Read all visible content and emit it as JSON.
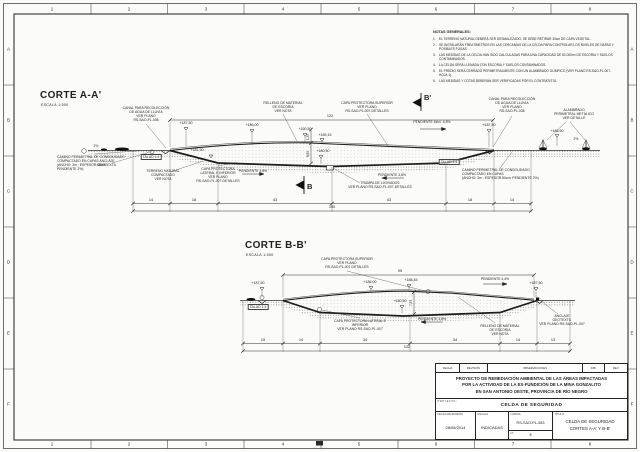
{
  "frame": {
    "cols": [
      "1",
      "2",
      "3",
      "4",
      "5",
      "6",
      "7",
      "8"
    ],
    "rows": [
      "A",
      "B",
      "C",
      "D",
      "E",
      "F"
    ]
  },
  "notes": {
    "title": "NOTAS GENERALES:",
    "items": [
      {
        "num": "1.",
        "text": "EL TERRENO NATURAL DEBERÁ SER DESMALEZADO. SE DEBE RETIRAR 30cm DE CAPA VEGETAL."
      },
      {
        "num": "2.",
        "text": "SE INSTALARÁN FREATÍMETROS EN LAS CERCANÍAS DE LA CELDA PARA CONTROLAR LOS NIVELES DE NAPAS Y POSIBLES FUGAS."
      },
      {
        "num": "3.",
        "text": "LAS MEDIDAS DE LA CELDA HAN SIDO CALCULADAS PARA UNA CAPACIDAD DE 60.000m³ DE ESCORIA Y SUELOS CONTAMINADOS."
      },
      {
        "num": "4.",
        "text": "LA CELDA SERÁ LLENADA CON ESCORIA Y SUELOS CONTAMINADOS."
      },
      {
        "num": "5.",
        "text": "EL PREDIO SERÁ CERRADO PERIMETRALMENTE CON UN ALAMBRADO OLÍMPICO (VER PLANO RS-SAO-PL-007-HOJA 1)."
      },
      {
        "num": "6.",
        "text": "LAS MEDIDAS Y COTAS DEBERÁN SER VERIFICADAS POR EL CONTRATISTA."
      }
    ]
  },
  "section_a": {
    "title": "CORTE A-A'",
    "scale": "ESCALA   1:500",
    "labels": {
      "canal": "CANAL PARA RECOLECCIÓN\nDE AGUA DE LLUVIA\nVER PLANO\nRS-SAO-PL-008",
      "relleno": "RELLENO DE MATERIAL\nDE ESCORIA\nVER NOTA",
      "capa_superior": "CAPA PROTECTORA SUPERIOR\nVER PLANO\nRS-SAO-PL-007-DETALLES",
      "alambrado": "ALAMBRADO\nPERIMETRAL METÁLICO\nVER DETALLE",
      "camino_left": "CAMINO PERIMETRAL DE CONSOLIDADO\nCOMPACTADO EN CAPAS\n(ANCHO: 3m ; ESPESOR:50cm;\nPENDIENTE 2%)",
      "camino_right": "CAMINO PERIMETRAL DE CONSOLIDADO\nCOMPACTADO EN CAPAS\n(ANCHO: 3m ; ESPESOR:50cm; PENDIENTE 2%)",
      "anclaje": "ANCLAJE\nGEOTEXTIL",
      "terreno": "TERRENO NATURAL\nCOMPACTADO\nVER NOTA",
      "capa_lateral": "CAPA PROTECTORA\nLATERAL E INFERIOR\nVER PLANO\nRS-SAO-PL-007-DETALLES",
      "talud": "TALUD 1:4",
      "pend": "PENDIENTE 3,8%",
      "pend_max": "PENDIENTE MAX. 6,5%",
      "trampa": "TRAMPA DE LIXIVIADOS\nVER PLANO RS-SAO-PL-007-DETALLES",
      "slope": "2%"
    },
    "elevations": {
      "left": "+187,50",
      "mid1": "+186,00",
      "crest": "+190,50",
      "mid2": "+189,15",
      "toe": "+181,50",
      "bottom": "+180,50",
      "right": "+187,50",
      "right2": "+186,50"
    },
    "dims": {
      "top": "122",
      "v1": "1,35",
      "v2": "8,65",
      "bottom": [
        "14",
        "18",
        "43",
        "43",
        "18",
        "14"
      ],
      "total": "150"
    },
    "markers": {
      "top": "B'",
      "bottom": "B"
    }
  },
  "section_b": {
    "title": "CORTE B-B'",
    "scale": "ESCALA   1:500",
    "labels": {
      "capa_superior": "CAPA PROTECTORA SUPERIOR\nVER PLANO\nRS-SAO-PL-007-DETALLES",
      "talud": "TALUD 1:4",
      "capa_lateral": "CAPA PROTECTORA LATERAL E\nINFERIOR\nVER PLANO RS-SAO-PL-007",
      "pend": "PENDIENTE 3,8%",
      "pend_top": "PENDIENTE 4,4%",
      "relleno": "RELLENO DE MATERIAL\nDE ESCORIA\nVER NOTA",
      "anclaje": "ANCLAJE\nGEOTEXTIL\nVER PLANO RS-SAO-PL-007"
    },
    "elevations": {
      "left": "+187,50",
      "mid1": "+186,00",
      "crest": "+188,45",
      "bottom": "+180,50",
      "right": "+187,50"
    },
    "dims": {
      "top": "95",
      "v": "7,95",
      "bottom": [
        "15",
        "14",
        "34",
        "34",
        "14",
        "13"
      ],
      "total": "122"
    }
  },
  "titleblock": {
    "rev_cols": [
      "FECHA",
      "REVISIÓN",
      "OBSERVACIONES",
      "DIB.",
      "REV."
    ],
    "project_title": "PROYECTO DE REMEDIACIÓN AMBIENTAL DE LAS ÁREAS IMPACTADAS\nPOR LA ACTIVIDAD DE LA EX-FUNDICIÓN DE LA MINA GONZALITO\nEN SAN ANTONIO OESTE, PROVINCIA DE RÍO NEGRO",
    "project_label": "PROYECTO:",
    "project_name": "CELDA DE SEGURIDAD",
    "date_label": "FECHA DE EMISIÓN",
    "date": "08/08/2014",
    "scale_label": "ESCALA",
    "scale": "INDICADAS",
    "sheet_label": "LÁMINA",
    "sheet_code": "RS-SAO-PL-083",
    "number_label": "Nº",
    "number": "8",
    "title_label": "TÍTULO:",
    "sheet_title": "CELDA DE SEGURIDAD\nCORTES A-A' Y B-B'"
  }
}
